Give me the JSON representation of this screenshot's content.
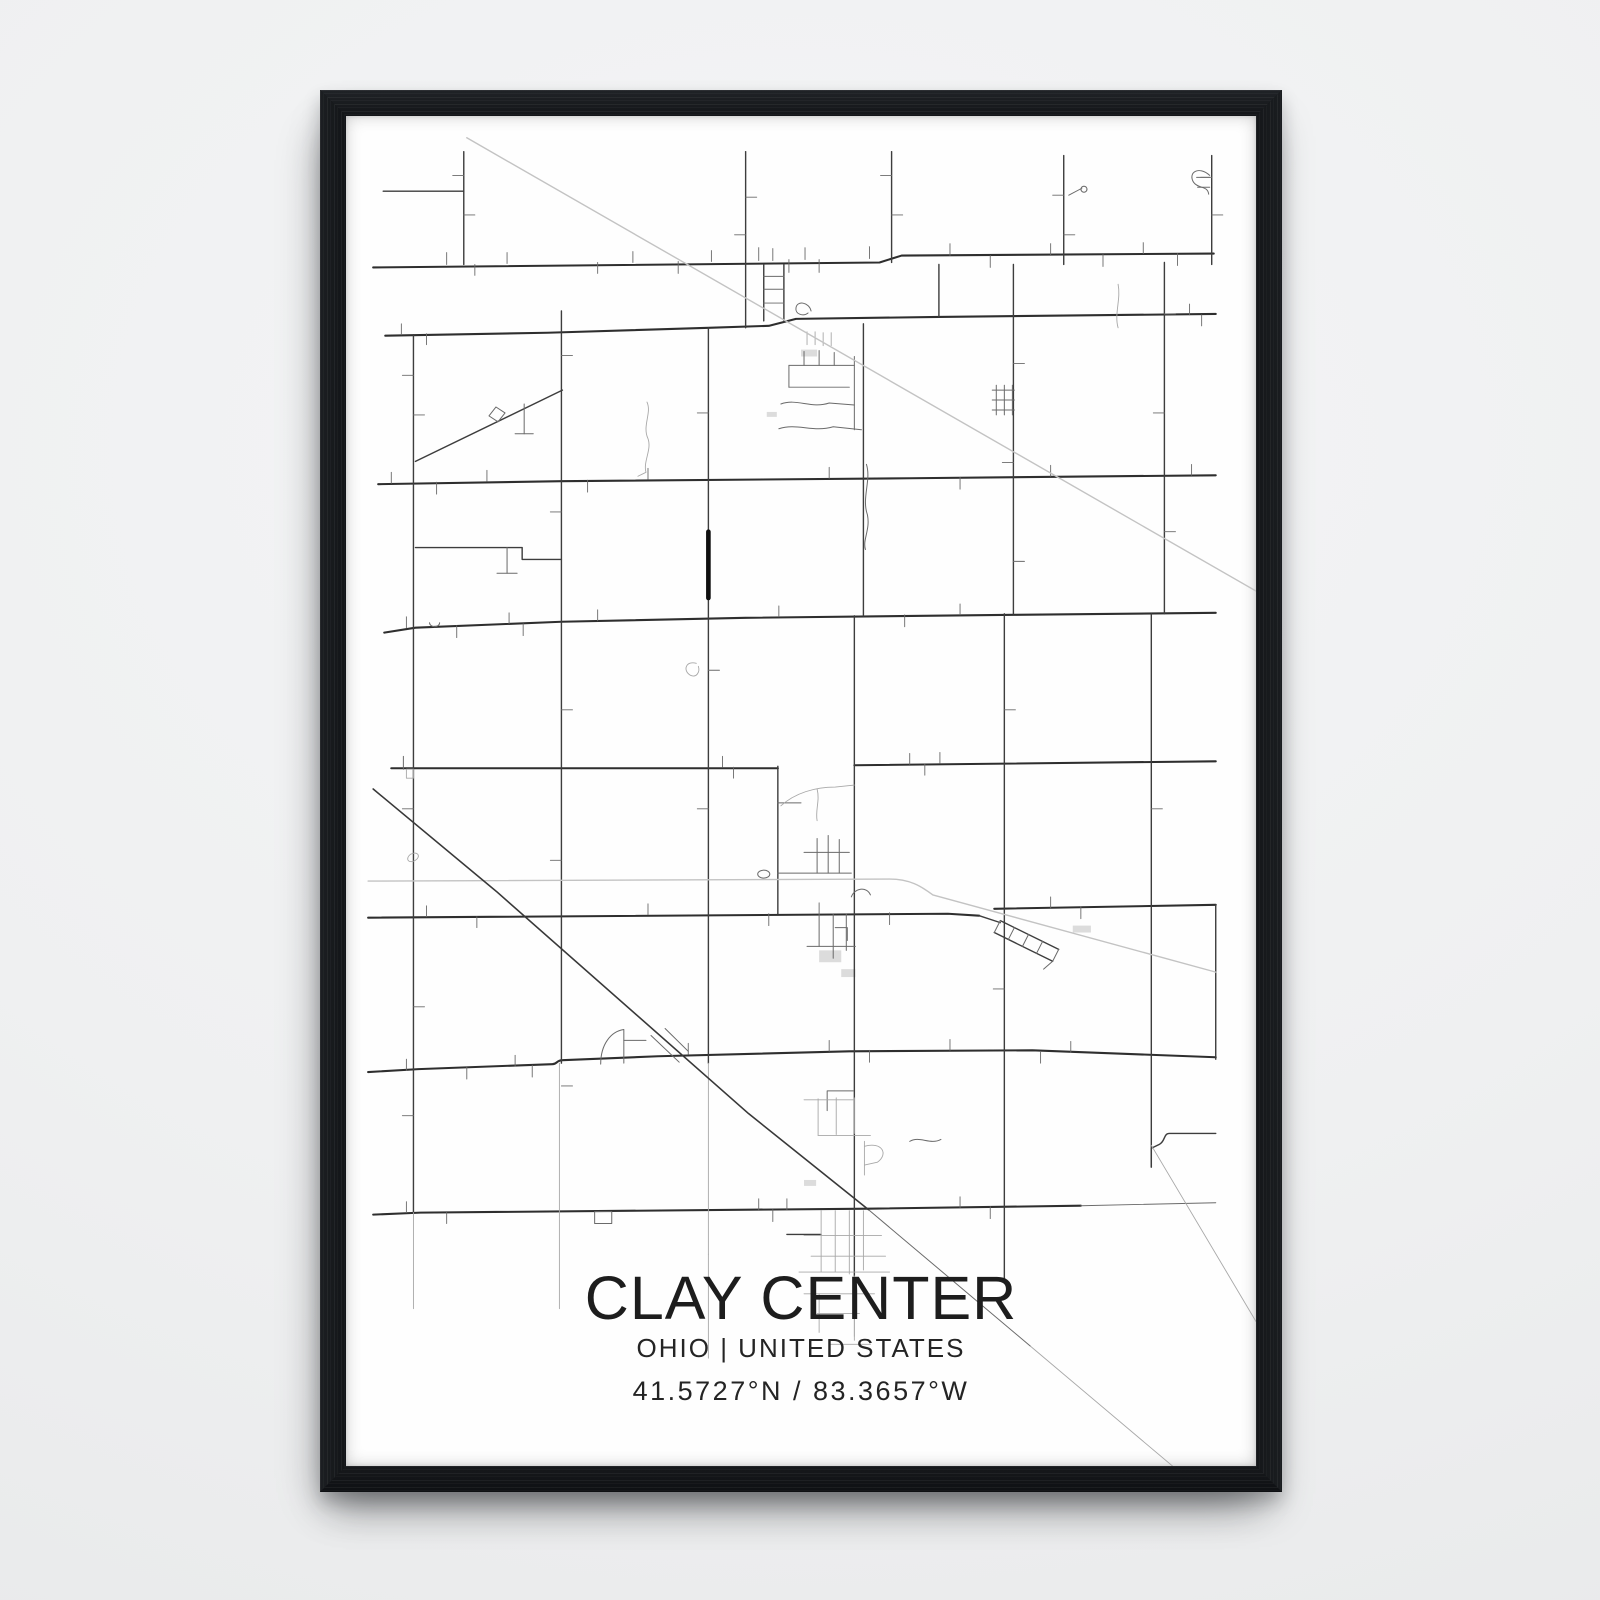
{
  "poster": {
    "title": "CLAY CENTER",
    "subtitle": "OHIO | UNITED STATES",
    "coordinates": "41.5727°N / 83.3657°W"
  },
  "colors": {
    "wall": "#eff0f1",
    "frame": "#131518",
    "paper": "#fefefe",
    "text": "#1d1d1d",
    "road_major": "#2e2e2e",
    "road": "#3d3d3d",
    "road_minor": "#6a6a6a",
    "road_faint": "#a8a8a8",
    "rail": "#c3c3c3",
    "rail_dark": "#383838",
    "bold": "#0f0f0f",
    "building": "#dcdcdc"
  },
  "map": {
    "viewbox": "0 0 904 1364",
    "groups": [
      {
        "name": "major-roads",
        "color_key": "road_major",
        "width": 2.1,
        "paths": [
          "M27 153 L530 148 L552 141 L862 139",
          "M39 222 L200 219 L360 214 L420 212 L447 205 L589 203 L864 200",
          "M32 372 L214 369 L560 366 L864 363",
          "M38 522 L69 517 L214 511 L397 507 L663 504 L864 502",
          "M45 659 H429",
          "M505 656 L864 652",
          "M22 810 L598 806 L629 808",
          "M644 801 L864 797",
          "M22 966 L72 963 L205 958 C210 958 209 954 215 954 L310 950 L500 945 L682 944 L864 951",
          "M27 1110 L74 1108 L519 1104 L730 1101"
        ]
      },
      {
        "name": "roads",
        "color_key": "road",
        "width": 1.4,
        "paths": [
          "M117 36 V150",
          "M37 76 H117",
          "M67 221 V1108",
          "M214 197 V957",
          "M397 36 V214",
          "M360 214 V957",
          "M514 210 V505",
          "M505 505 V1172",
          "M542 36 V148",
          "M589 150 V203",
          "M713 40 V150",
          "M663 150 V503",
          "M654 503 V1175",
          "M860 40 V150",
          "M813 148 V503",
          "M800 503 V1062",
          "M864 797 V953",
          "M429 657 V806",
          "M69 436 H175 V448 H214",
          "M69 349 L215 277",
          "M864 1028 H818 C812 1028 814 1036 808 1039 L800 1043 V1062",
          "M629 808 L650 815",
          "M650 813 L708 842",
          "M644 825 L702 854",
          "M438 1130 H472",
          "M415 150 V207",
          "M435 150 V207"
        ]
      },
      {
        "name": "minor-roads",
        "color_key": "road_minor",
        "width": 1,
        "paths": [
          "M415 162 H435",
          "M415 175 H435",
          "M415 189 H435",
          "M650 813 L644 825",
          "M664 820 L658 832",
          "M678 827 L672 839",
          "M692 834 L686 846",
          "M708 842 L702 854",
          "M702 854 L693 862",
          "M160 436 V462",
          "M150 462 H170",
          "M177 291 V321",
          "M168 321 H186",
          "M142 303 l7 -9 l9 6 l-7 9 z",
          "M440 252 V274",
          "M440 252 H505",
          "M455 252 V238",
          "M470 252 V237",
          "M485 252 V239",
          "M505 243 V317",
          "M440 274 H500",
          "M432 291 C448 285 462 296 480 290 L505 292",
          "M430 316 C448 310 464 320 484 314 L512 317",
          "M462 197 C460 188 448 186 447 194 C446 200 454 203 459 199",
          "M429 694 H452",
          "M429 765 H502",
          "M468 730 V765",
          "M479 727 V765",
          "M490 731 V765",
          "M455 744 H500",
          "M409 766 a6 4 0 1 0 12 0 a6 4 0 1 0 -12 0",
          "M470 806 V839",
          "M484 806 V851",
          "M497 806 V843",
          "M458 839 H506",
          "M486 820 H498 V833",
          "M502 789 C505 780 517 778 521 787",
          "M253 958 C253 938 263 925 276 923 L276 957",
          "M276 934 H298",
          "M303 929 L331 956",
          "M317 922 L340 945",
          "M504 985 H478 V1005",
          "M858 60 C847 50 836 57 842 67 C847 74 856 70 857 79",
          "M845 62 H858",
          "M846 72 H858",
          "M560 1036 C570 1030 580 1040 591 1034",
          "M517 352 C522 368 512 386 518 403 C521 418 513 428 516 438",
          "M730 1101 L864 1098",
          "M519 1105 L680 1243",
          "M247 1107 h17 v12 h-17 z",
          "M642 277 H664",
          "M642 287 H664",
          "M642 297 H664",
          "M646 272 V302",
          "M654 272 V302",
          "M662 272 V302",
          "M718 80 L731 73",
          "M733 71 a3 3 0 1 0 0.2 0",
          "M83 512 a5 4 0 1 0 10 0",
          "M57 647 V660"
        ]
      },
      {
        "name": "driveway-ticks",
        "color_key": "road_minor",
        "width": 0.9,
        "paths": [
          "M100 150 V138",
          "M128 150 V161",
          "M160 149 V138",
          "M250 148 V159",
          "M285 148 V137",
          "M330 147 V159",
          "M363 147 V136",
          "M410 146 V133",
          "M424 146 V134",
          "M440 145 V158",
          "M456 145 V133",
          "M470 145 V158",
          "M520 144 V132",
          "M600 141 V129",
          "M640 141 V153",
          "M700 140 V129",
          "M752 140 V152",
          "M792 139 V128",
          "M826 139 V151",
          "M55 221 V210",
          "M80 220 V231",
          "M838 201 V190",
          "M850 201 V212",
          "M45 371 V360",
          "M90 370 V382",
          "M140 369 V358",
          "M240 368 V380",
          "M300 367 V356",
          "M480 366 V355",
          "M610 365 V377",
          "M700 364 V353",
          "M840 363 V352",
          "M60 517 V506",
          "M110 515 V527",
          "M162 513 V502",
          "M176 513 V525",
          "M250 510 V499",
          "M430 506 V495",
          "M555 504 V516",
          "M610 504 V493",
          "M374 658 V647",
          "M385 658 V669",
          "M560 655 V644",
          "M575 655 V666",
          "M590 654 V643",
          "M80 809 V798",
          "M130 809 V820",
          "M300 807 V796",
          "M420 806 V818",
          "M470 806 V795",
          "M540 805 V817",
          "M700 800 V789",
          "M730 799 V811",
          "M60 964 V953",
          "M120 961 V973",
          "M168 960 V949",
          "M185 959 V971",
          "M340 948 V937",
          "M480 945 V934",
          "M520 944 V956",
          "M600 944 V933",
          "M690 945 V957",
          "M720 946 V935",
          "M60 1108 V1097",
          "M100 1108 V1119",
          "M410 1105 V1094",
          "M424 1105 V1117",
          "M438 1105 V1094",
          "M610 1103 V1092",
          "M640 1102 V1114",
          "M67 262 H56",
          "M67 302 H78",
          "M67 700 H56",
          "M67 900 H78",
          "M67 1010 H56",
          "M214 242 H225",
          "M214 400 H203",
          "M214 600 H225",
          "M214 752 H203",
          "M214 980 H225",
          "M397 82 H408",
          "M397 120 H386",
          "M360 300 H349",
          "M360 560 H371",
          "M360 700 H349",
          "M663 250 H674",
          "M663 350 H652",
          "M663 450 H674",
          "M654 600 H665",
          "M654 882 H643",
          "M813 200 H824",
          "M813 300 H802",
          "M813 420 H824",
          "M800 700 H811",
          "M117 60 H106",
          "M117 100 H128",
          "M542 60 H531",
          "M542 100 H553",
          "M713 80 H702",
          "M713 120 H724",
          "M860 62 H849",
          "M860 100 H871"
        ]
      },
      {
        "name": "faint-roads",
        "color_key": "road_faint",
        "width": 0.9,
        "paths": [
          "M299 289 C304 300 294 313 300 326 C304 337 295 349 298 360 L290 364",
          "M432 697 C446 684 466 678 486 678 L505 676",
          "M468 680 C471 692 466 701 468 712",
          "M472 1106 V1168",
          "M486 1106 V1168",
          "M500 1106 V1170",
          "M514 1106 V1166",
          "M455 1131 H532",
          "M462 1152 H536",
          "M450 1168 H540",
          "M455 1190 H525",
          "M470 1190 V1229",
          "M505 1190 V1233",
          "M480 1241 H521",
          "M468 1210 H510",
          "M469 993 V1030",
          "M487 992 V1029",
          "M505 992 V1028",
          "M455 994 H505",
          "M469 1030 H521",
          "M515 1036 V1070",
          "M515 1041 C533 1036 539 1049 528 1057 L515 1060",
          "M458 218 V231",
          "M466 218 V231",
          "M474 219 V232",
          "M482 219 V232",
          "M680 1243 L821 1364",
          "M800 1040 L904 1218",
          "M767 170 C770 185 763 200 767 214",
          "M360 957 V1150",
          "M360 1150 V1255",
          "M505 1172 V1237",
          "M67 1108 V1205",
          "M212 957 V1205",
          "M60 660 h7 v9 h-7 z",
          "M64 746 c7 -4 11 2 5 6 c-6 4 -11 -1 -5 -6",
          "M348 553 C338 550 334 560 342 565 C348 568 352 562 350 556"
        ]
      },
      {
        "name": "railway",
        "color_key": "rail",
        "width": 1.4,
        "paths": [
          "M120 22 L904 480",
          "M22 773 L540 771 C560 771 571 778 583 787 L864 865"
        ]
      },
      {
        "name": "railway-dark",
        "color_key": "rail_dark",
        "width": 1.6,
        "paths": [
          "M27 680 L150 784 L400 1008 L519 1105"
        ]
      },
      {
        "name": "highlighted-road",
        "color_key": "bold",
        "width": 4.6,
        "paths": [
          "M360 420 V487"
        ]
      }
    ],
    "buildings": [
      {
        "x": 452,
        "y": 236,
        "w": 16,
        "h": 7
      },
      {
        "x": 722,
        "y": 818,
        "w": 18,
        "h": 7
      },
      {
        "x": 470,
        "y": 843,
        "w": 22,
        "h": 12
      },
      {
        "x": 492,
        "y": 862,
        "w": 14,
        "h": 8
      },
      {
        "x": 455,
        "y": 1075,
        "w": 12,
        "h": 6
      },
      {
        "x": 418,
        "y": 299,
        "w": 10,
        "h": 5
      }
    ]
  }
}
